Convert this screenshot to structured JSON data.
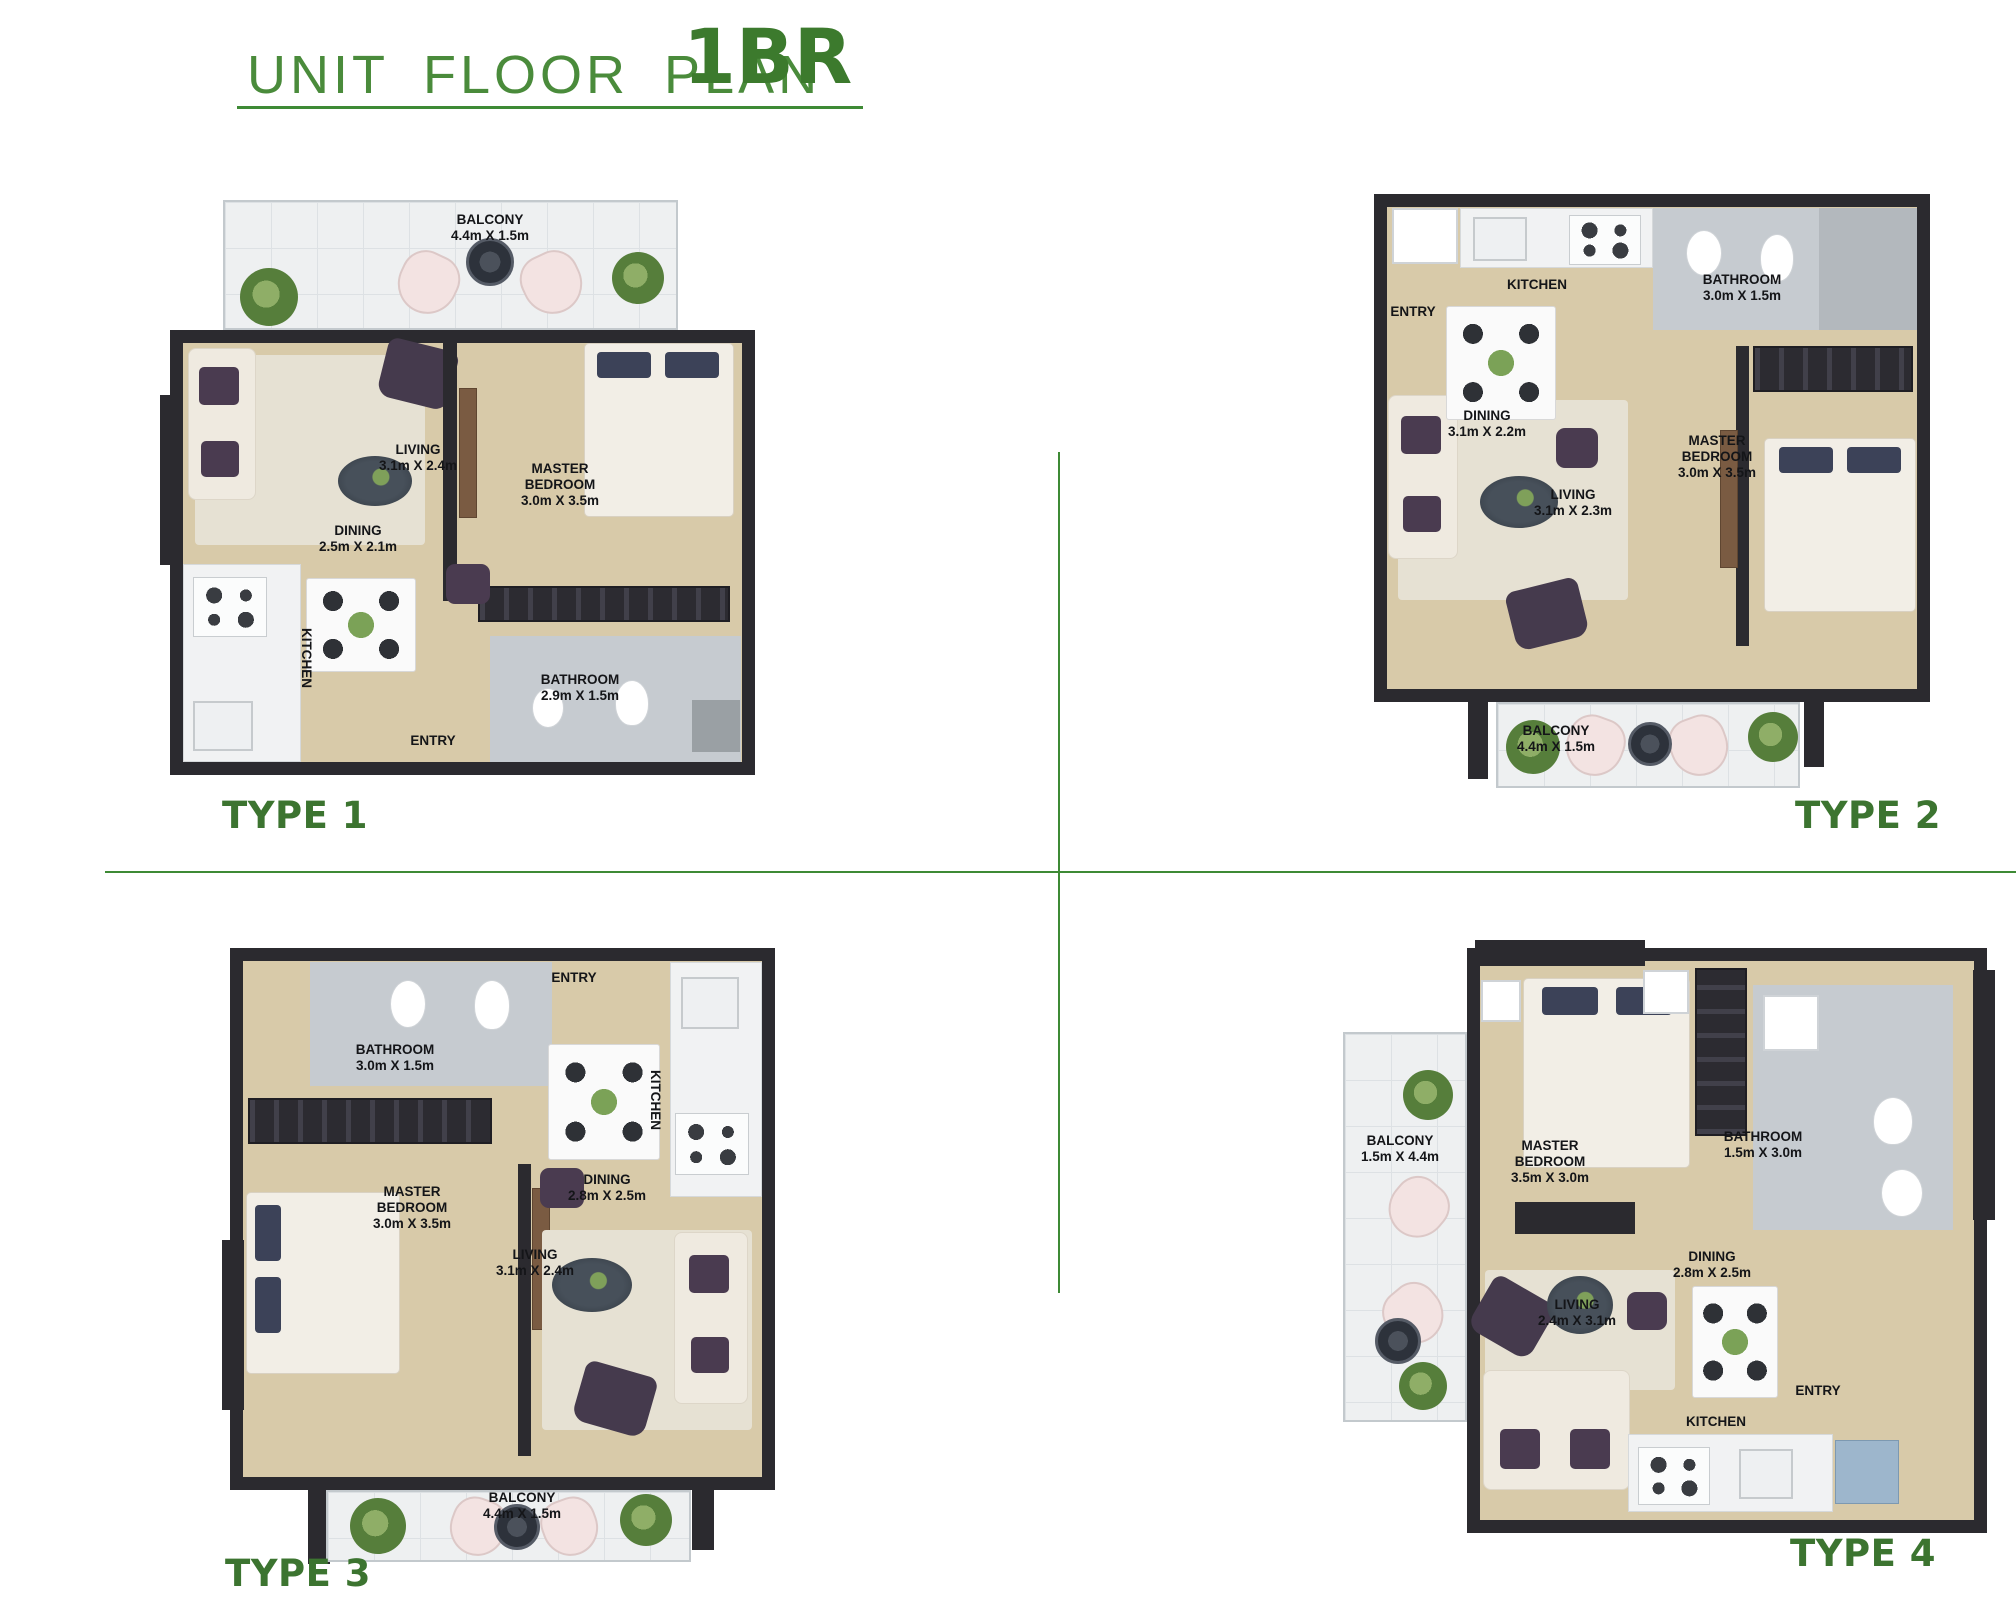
{
  "header": {
    "title": "UNIT FLOOR PLAN",
    "unit_type": "1BR"
  },
  "colors": {
    "title_green": "#4a8b3b",
    "accent_green_dark": "#3c7430",
    "divider_green": "#3e8a35",
    "wall_dark": "#2b2a2f",
    "floor_beige": "#d8caa9",
    "balcony_tile": "#eef0f1",
    "bathroom_gray": "#c6cbd0"
  },
  "plans": [
    {
      "label": "TYPE 1",
      "rooms": [
        {
          "name": "BALCONY",
          "dim": "4.4m X 1.5m"
        },
        {
          "name": "LIVING",
          "dim": "3.1m X 2.4m"
        },
        {
          "name": "MASTER BEDROOM",
          "dim": "3.0m X 3.5m"
        },
        {
          "name": "DINING",
          "dim": "2.5m X 2.1m"
        },
        {
          "name": "KITCHEN",
          "dim": ""
        },
        {
          "name": "BATHROOM",
          "dim": "2.9m X 1.5m"
        },
        {
          "name": "ENTRY",
          "dim": ""
        }
      ]
    },
    {
      "label": "TYPE 2",
      "rooms": [
        {
          "name": "ENTRY",
          "dim": ""
        },
        {
          "name": "KITCHEN",
          "dim": ""
        },
        {
          "name": "BATHROOM",
          "dim": "3.0m X 1.5m"
        },
        {
          "name": "DINING",
          "dim": "3.1m X 2.2m"
        },
        {
          "name": "LIVING",
          "dim": "3.1m X 2.3m"
        },
        {
          "name": "MASTER BEDROOM",
          "dim": "3.0m X 3.5m"
        },
        {
          "name": "BALCONY",
          "dim": "4.4m X 1.5m"
        }
      ]
    },
    {
      "label": "TYPE 3",
      "rooms": [
        {
          "name": "BATHROOM",
          "dim": "3.0m X 1.5m"
        },
        {
          "name": "ENTRY",
          "dim": ""
        },
        {
          "name": "KITCHEN",
          "dim": ""
        },
        {
          "name": "MASTER BEDROOM",
          "dim": "3.0m X 3.5m"
        },
        {
          "name": "DINING",
          "dim": "2.8m X 2.5m"
        },
        {
          "name": "LIVING",
          "dim": "3.1m X 2.4m"
        },
        {
          "name": "BALCONY",
          "dim": "4.4m X 1.5m"
        }
      ]
    },
    {
      "label": "TYPE 4",
      "rooms": [
        {
          "name": "BALCONY",
          "dim": "1.5m X 4.4m"
        },
        {
          "name": "MASTER BEDROOM",
          "dim": "3.5m X 3.0m"
        },
        {
          "name": "BATHROOM",
          "dim": "1.5m X 3.0m"
        },
        {
          "name": "DINING",
          "dim": "2.8m X 2.5m"
        },
        {
          "name": "LIVING",
          "dim": "2.4m X 3.1m"
        },
        {
          "name": "KITCHEN",
          "dim": ""
        },
        {
          "name": "ENTRY",
          "dim": ""
        }
      ]
    }
  ]
}
